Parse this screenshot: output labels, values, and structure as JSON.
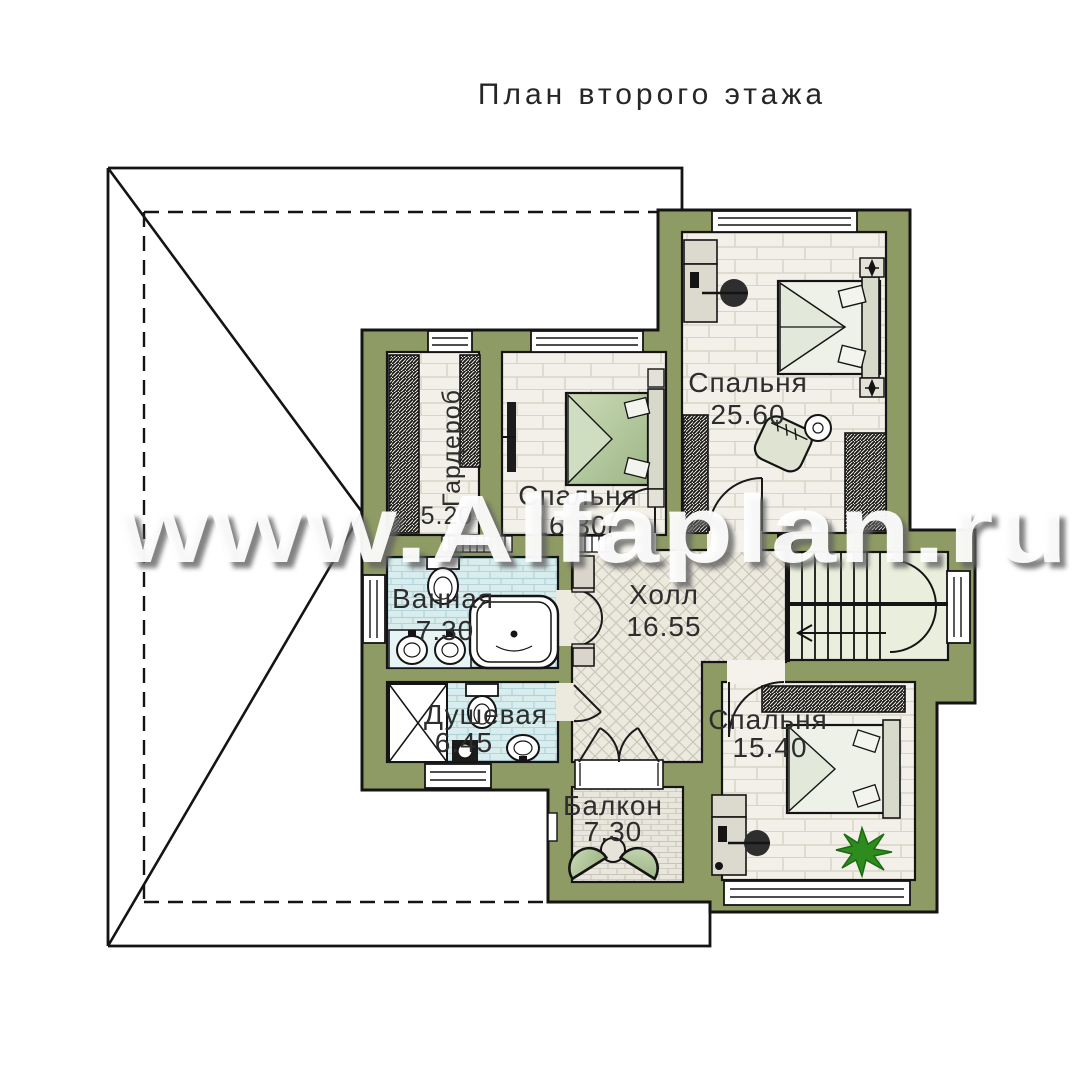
{
  "title": "План второго этажа",
  "watermark": "www.Alfaplan.ru",
  "rooms": {
    "bedroom1": {
      "name": "Спальня",
      "area": "25.60"
    },
    "bedroom2": {
      "name": "Спальня",
      "area": "16.30"
    },
    "wardrobe": {
      "name": "Гардероб",
      "area": "5.20"
    },
    "bathroom": {
      "name": "Ванная",
      "area": "7.30"
    },
    "shower": {
      "name": "Душевая",
      "area": "6.45"
    },
    "hall": {
      "name": "Холл",
      "area": "16.55"
    },
    "bedroom3": {
      "name": "Спальня",
      "area": "15.40"
    },
    "balcony": {
      "name": "Балкон",
      "area": "7.30"
    }
  },
  "colors": {
    "wall": "#8e9b64",
    "outline": "#141414",
    "bedroom_floor": "#f2f0e8",
    "bathroom_tile": "#d9edee",
    "hall_tile": "#ece9df",
    "balcony_floor": "#e9e6dd",
    "stair_floor": "#e9efdc",
    "furniture_green": "#c3d5ab",
    "plant_green": "#2e8b1e",
    "label": "#2d2d2d"
  }
}
